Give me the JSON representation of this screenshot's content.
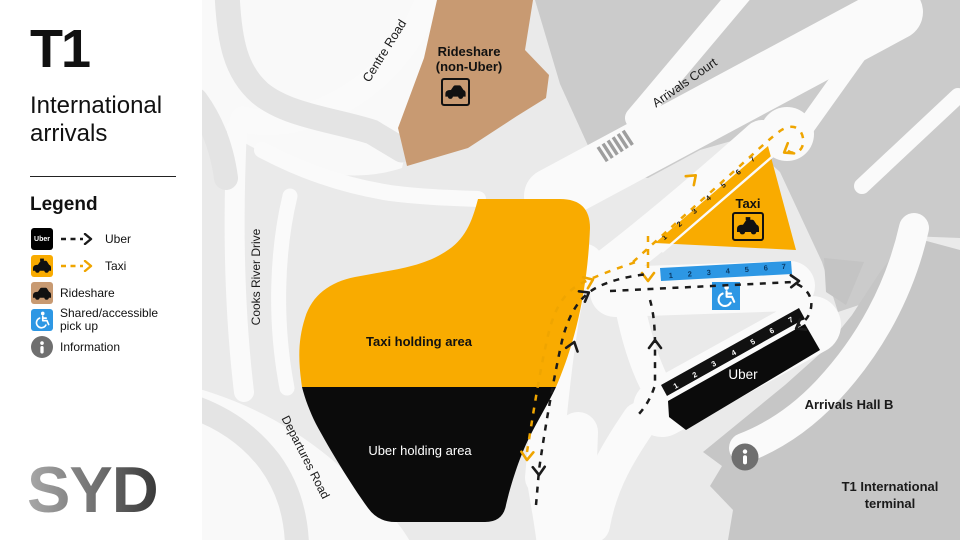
{
  "sidebar": {
    "terminal_code": "T1",
    "subtitle_line1": "International",
    "subtitle_line2": "arrivals",
    "legend_title": "Legend",
    "legend": {
      "uber": {
        "label": "Uber",
        "badge_text": "Uber"
      },
      "taxi": {
        "label": "Taxi"
      },
      "rideshare": {
        "label": "Rideshare"
      },
      "accessible": {
        "label_line1": "Shared/accessible",
        "label_line2": "pick up"
      },
      "information": {
        "label": "Information"
      }
    },
    "airport_code": "SYD"
  },
  "map": {
    "roads": {
      "centre_road": "Centre Road",
      "arrivals_court": "Arrivals Court",
      "cooks_river_drive": "Cooks River Drive",
      "departures_road": "Departures Road"
    },
    "areas": {
      "rideshare_line1": "Rideshare",
      "rideshare_line2": "(non-Uber)",
      "taxi_holding": "Taxi holding area",
      "uber_holding": "Uber holding area",
      "taxi_rank": "Taxi",
      "uber_rank": "Uber",
      "arrivals_hall": "Arrivals Hall B",
      "terminal_line1": "T1 International",
      "terminal_line2": "terminal"
    },
    "bays": {
      "taxi": [
        "1",
        "2",
        "3",
        "4",
        "5",
        "6",
        "7"
      ],
      "uber": [
        "1",
        "2",
        "3",
        "4",
        "5",
        "6",
        "7"
      ],
      "accessible": [
        "1",
        "2",
        "3",
        "4",
        "5",
        "6",
        "7"
      ]
    },
    "colors": {
      "taxi_yellow": "#F9AB00",
      "uber_black": "#111111",
      "rideshare_brown": "#C89A72",
      "accessible_blue": "#2D97E4",
      "info_gray": "#6F6F6F",
      "background": "#EAEAEA",
      "building_gray": "#CBCBCB",
      "road_white": "#FAFAFA",
      "path_yellow": "#EFA500",
      "path_black": "#1B1B1B"
    }
  }
}
